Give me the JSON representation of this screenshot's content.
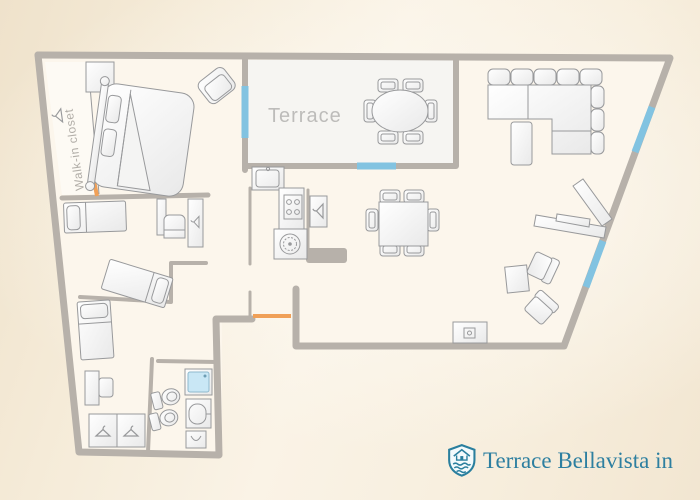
{
  "labels": {
    "terrace": "Terrace",
    "walk_in_closet": "Walk-in closet"
  },
  "branding": {
    "name": "Terrace Bellavista in",
    "icon": "brand-shield-icon",
    "color": "#2d7fa0"
  },
  "palette": {
    "background_beige": "#f2e6d1",
    "wall_gray": "#b7b1aa",
    "window_blue": "#82c3e1",
    "door_orange": "#f0a058",
    "room_fill": "#fcf6ec",
    "terrace_fill": "#f6f5f2",
    "furniture_stroke": "#98999b",
    "label_gray": "#bdbcba"
  },
  "rooms": [
    {
      "name": "master-bedroom",
      "furniture": [
        "walk-in-closet",
        "nightstand",
        "double-bed",
        "armchair"
      ]
    },
    {
      "name": "terrace",
      "furniture": [
        "oval-table",
        "six-chairs"
      ]
    },
    {
      "name": "living-room",
      "furniture": [
        "sectional-sofa",
        "ottoman",
        "chaise-lounge",
        "two-armchairs",
        "side-table",
        "tv-unit"
      ]
    },
    {
      "name": "dining-area",
      "furniture": [
        "dining-table",
        "six-chairs",
        "wardrobe"
      ]
    },
    {
      "name": "kitchen",
      "furniture": [
        "sink-counter",
        "stove",
        "washing-machine"
      ]
    },
    {
      "name": "bedroom-2",
      "furniture": [
        "single-bed",
        "single-bed-angled",
        "desk",
        "cabinet"
      ]
    },
    {
      "name": "bedroom-3",
      "furniture": [
        "single-bed",
        "desk",
        "chair",
        "double-wardrobe"
      ]
    },
    {
      "name": "bathroom",
      "furniture": [
        "shower",
        "toilet",
        "bidet",
        "sink"
      ]
    }
  ],
  "openings": {
    "windows": 4,
    "doors": 2
  }
}
